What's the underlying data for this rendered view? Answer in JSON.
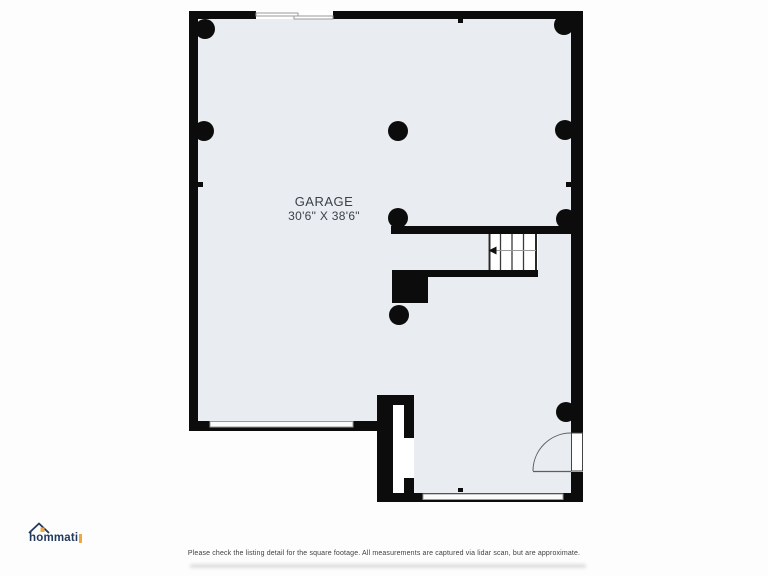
{
  "plan": {
    "room_label": "GARAGE",
    "room_dimensions": "30'6\" X 38'6\""
  },
  "footer": {
    "disclaimer": "Please check the listing detail for the square footage. All measurements are captured via lidar scan, but are approximate.",
    "logo_text": "hommati"
  },
  "colors": {
    "wall": "#0c0c0c",
    "floor": "#e9edf1",
    "background": "#fdfdfd",
    "stair_fill": "#ffffff",
    "line": "#5f5f5f",
    "window_line": "#9a9a9a",
    "tread": "#2a2a2a",
    "label_text": "#39414a",
    "disclaimer_text": "#3f3f3f",
    "logo_navy": "#223a5e",
    "logo_orange": "#f2a63c"
  }
}
